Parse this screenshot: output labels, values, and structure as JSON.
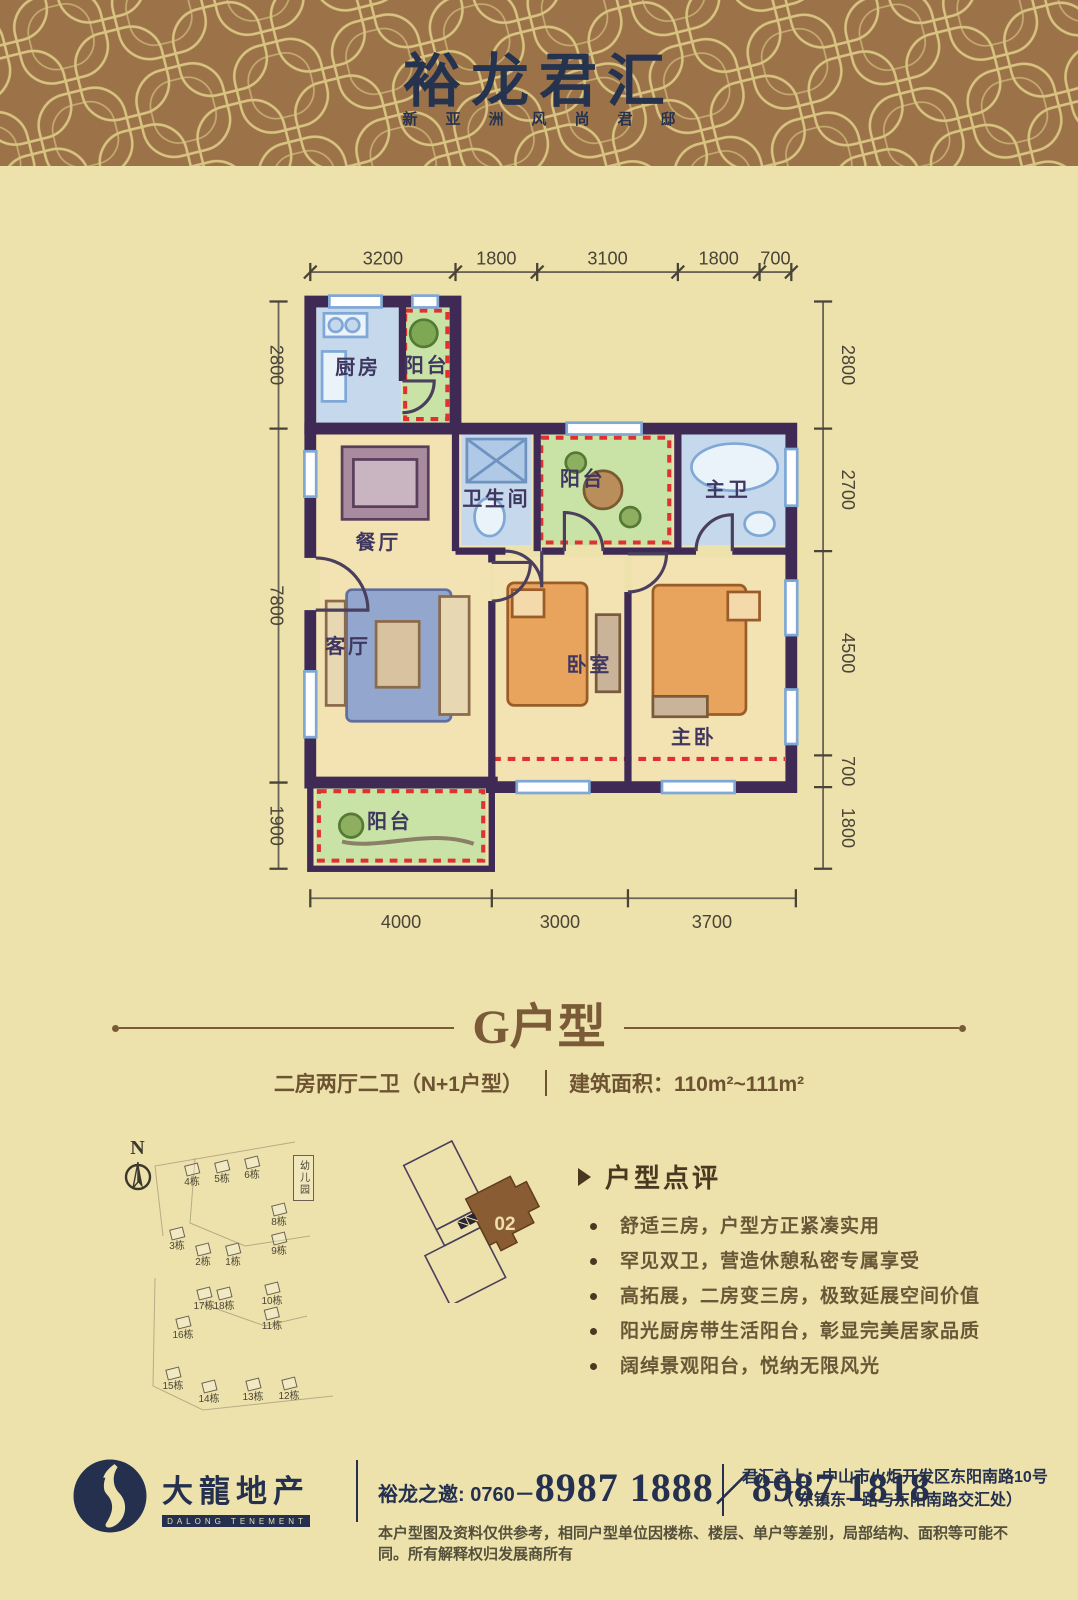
{
  "header": {
    "title": "裕龙君汇",
    "subtitle": "新亚洲风尚君邸"
  },
  "plan": {
    "dims": {
      "top": [
        "3200",
        "1800",
        "3100",
        "1800",
        "700"
      ],
      "left": [
        "2800",
        "7800",
        "1900"
      ],
      "right": [
        "2800",
        "2700",
        "4500",
        "700",
        "1800"
      ],
      "bottom": [
        "4000",
        "3000",
        "3700"
      ]
    },
    "rooms": {
      "kitchen": "厨房",
      "service_balcony": "阳台",
      "bathroom": "卫生间",
      "mid_balcony": "阳台",
      "master_bath": "主卫",
      "dining": "餐厅",
      "living": "客厅",
      "bedroom": "卧室",
      "master_bedroom": "主卧",
      "bottom_balcony": "阳台"
    }
  },
  "unit": {
    "name": "G户型",
    "spec": "二房两厅二卫（N+1户型）",
    "area": "建筑面积：110m²~111m²"
  },
  "siteplan": {
    "compass": "N",
    "kindergarten": "幼儿园",
    "buildings": [
      {
        "label": "4栋"
      },
      {
        "label": "5栋"
      },
      {
        "label": "6栋"
      },
      {
        "label": "3栋"
      },
      {
        "label": "2栋"
      },
      {
        "label": "1栋"
      },
      {
        "label": "8栋"
      },
      {
        "label": "9栋"
      },
      {
        "label": "17栋"
      },
      {
        "label": "18栋"
      },
      {
        "label": "16栋"
      },
      {
        "label": "10栋"
      },
      {
        "label": "11栋"
      },
      {
        "label": "15栋"
      },
      {
        "label": "14栋"
      },
      {
        "label": "13栋"
      },
      {
        "label": "12栋"
      }
    ]
  },
  "locator": {
    "unit_label": "02"
  },
  "review": {
    "title": "户型点评",
    "items": [
      "舒适三房，户型方正紧凑实用",
      "罕见双卫，营造休憩私密专属享受",
      "高拓展，二房变三房，极致延展空间价值",
      "阳光厨房带生活阳台，彰显完美居家品质",
      "阔绰景观阳台，悦纳无限风光"
    ]
  },
  "footer": {
    "logo_cn": "大龍地产",
    "logo_en": "DALONG TENEMENT",
    "phone_prefix": "裕龙之邀: 0760－",
    "phone_1": "8987 1888",
    "phone_slash": "／",
    "phone_2": "8987 1818",
    "address_label": "君汇之上：",
    "address_line1": "中山市火炬开发区东阳南路10号",
    "address_line2": "（ 东镇东一路与东阳南路交汇处）",
    "disclaimer": "本户型图及资料仅供参考，相同户型单位因楼栋、楼层、单户等差别，局部结构、面积等可能不同。所有解释权归发展商所有"
  },
  "colors": {
    "background": "#EDE2AC",
    "header_band": "#9C7349",
    "pattern_line": "#D8C380",
    "navy": "#24304E",
    "brown_text": "#7B5B37",
    "wall": "#3E2A54",
    "balcony_green": "#C9E3A6",
    "wet_room_blue": "#C6D8EC",
    "floor_warm": "#F4E3B2",
    "red_dash": "#E03030",
    "unit_highlight": "#8A5C33"
  }
}
